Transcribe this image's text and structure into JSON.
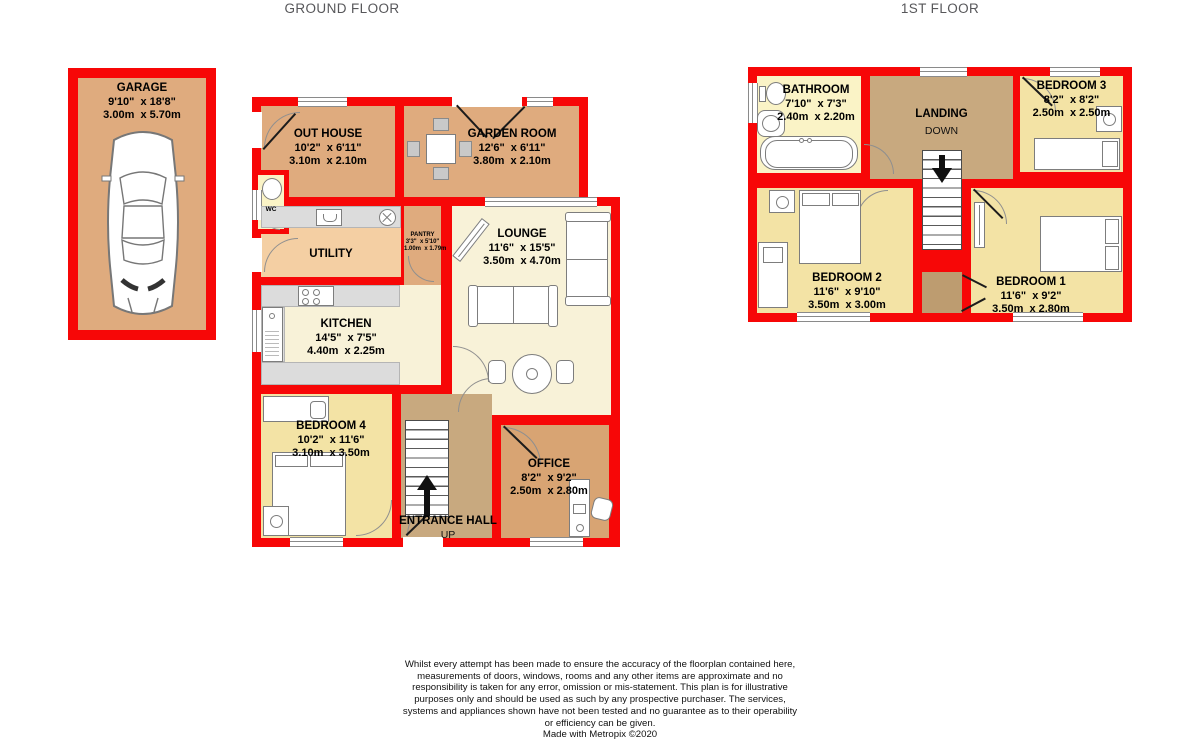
{
  "titles": {
    "ground": "GROUND FLOOR",
    "first": "1ST FLOOR"
  },
  "rooms": {
    "garage": {
      "name": "GARAGE",
      "imperial": "9'10\"  x 18'8\"",
      "metric": "3.00m  x 5.70m"
    },
    "out_house": {
      "name": "OUT HOUSE",
      "imperial": "10'2\"  x 6'11\"",
      "metric": "3.10m  x 2.10m"
    },
    "garden_room": {
      "name": "GARDEN ROOM",
      "imperial": "12'6\"  x 6'11\"",
      "metric": "3.80m  x 2.10m"
    },
    "lounge": {
      "name": "LOUNGE",
      "imperial": "11'6\"  x 15'5\"",
      "metric": "3.50m  x 4.70m"
    },
    "utility": {
      "name": "UTILITY"
    },
    "pantry": {
      "name": "PANTRY",
      "imperial": "3'3\"  x 5'10\"",
      "metric": "1.00m  x 1.79m"
    },
    "wc": {
      "name": "WC"
    },
    "kitchen": {
      "name": "KITCHEN",
      "imperial": "14'5\"  x 7'5\"",
      "metric": "4.40m  x 2.25m"
    },
    "bedroom4": {
      "name": "BEDROOM 4",
      "imperial": "10'2\"  x 11'6\"",
      "metric": "3.10m  x 3.50m"
    },
    "entrance_hall": {
      "name": "ENTRANCE HALL",
      "direction": "UP"
    },
    "office": {
      "name": "OFFICE",
      "imperial": "8'2\"  x 9'2\"",
      "metric": "2.50m  x 2.80m"
    },
    "bathroom": {
      "name": "BATHROOM",
      "imperial": "7'10\"  x 7'3\"",
      "metric": "2.40m  x 2.20m"
    },
    "landing": {
      "name": "LANDING",
      "direction": "DOWN"
    },
    "bedroom3": {
      "name": "BEDROOM 3",
      "imperial": "8'2\"  x 8'2\"",
      "metric": "2.50m  x 2.50m"
    },
    "bedroom2": {
      "name": "BEDROOM 2",
      "imperial": "11'6\"  x 9'10\"",
      "metric": "3.50m  x 3.00m"
    },
    "bedroom1": {
      "name": "BEDROOM 1",
      "imperial": "11'6\"  x 9'2\"",
      "metric": "3.50m  x 2.80m"
    }
  },
  "footer": {
    "disclaimer": "Whilst every attempt has been made to ensure the accuracy of the floorplan contained here, measurements of doors, windows, rooms and any other items are approximate and no responsibility is taken for any error, omission or mis-statement. This plan is for illustrative purposes only and should be used as such by any prospective purchaser. The services, systems and appliances shown have not been tested and no guarantee as to their operability or efficiency can be given.",
    "credit": "Made with Metropix ©2020"
  },
  "colors": {
    "wall_red": "#f70707",
    "tan": "#dfab7e",
    "office_tan": "#d8a473",
    "utility_peach": "#f4cfa3",
    "cream": "#f8f2d8",
    "bedroom_yellow": "#f3e3a5",
    "bathroom_yellow": "#faf3c6",
    "hall_brown": "#c8a97f",
    "counter_gray": "#dcdcdc"
  }
}
